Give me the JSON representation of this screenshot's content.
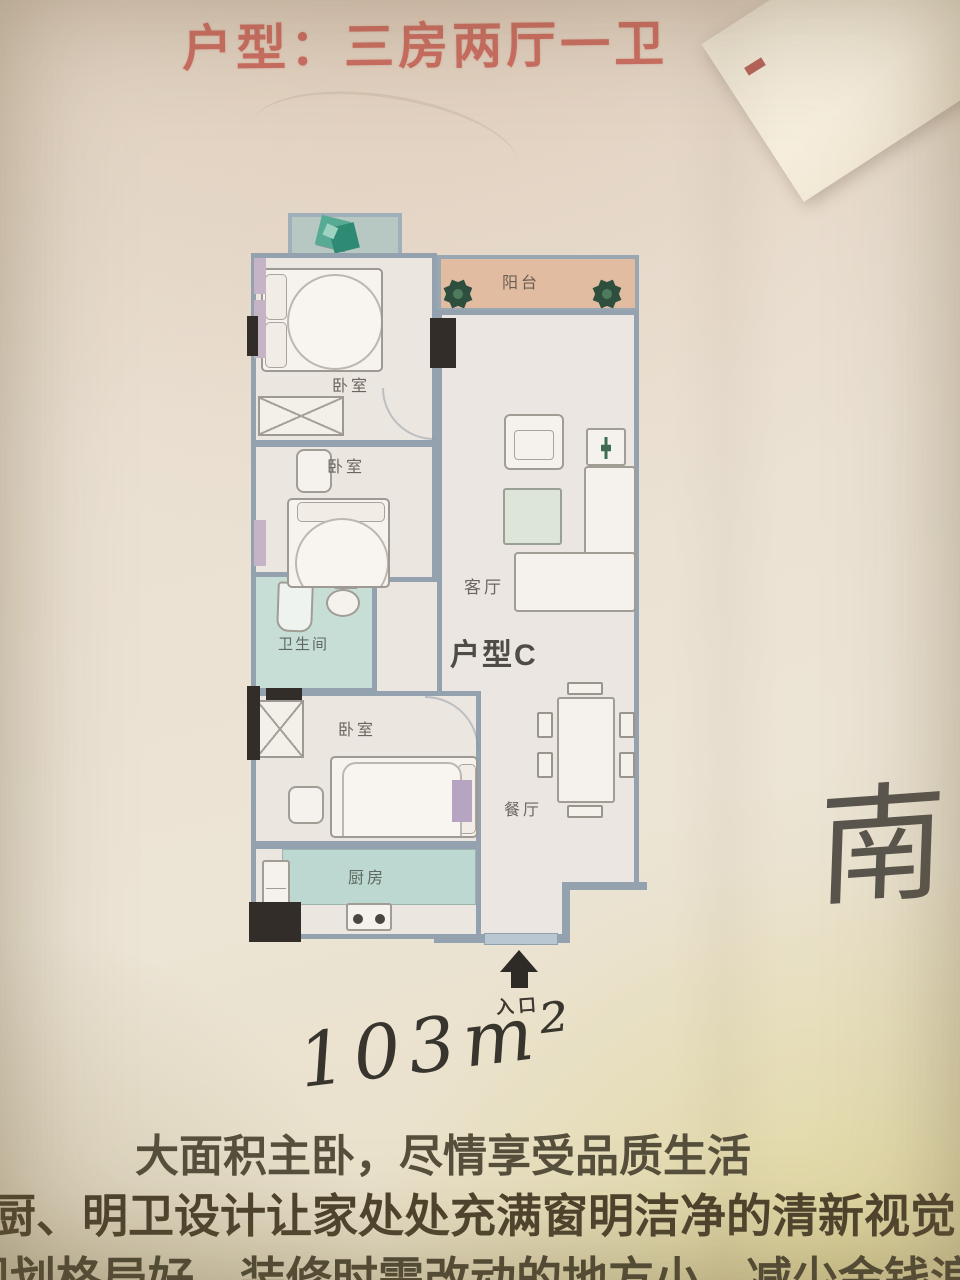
{
  "title": "户型：三房两厅一卫",
  "plan": {
    "unit_label": "户型C",
    "rooms": {
      "bedroom1": "卧室",
      "bedroom2": "卧室",
      "bedroom3": "卧室",
      "bathroom": "卫生间",
      "living": "客厅",
      "dining": "餐厅",
      "kitchen": "厨房",
      "balcony": "阳台"
    },
    "entrance_label": "入口"
  },
  "annotations": {
    "area_handwritten": "103m²",
    "direction_south": "南"
  },
  "footer": {
    "line1": "大面积主卧，尽情享受品质生活",
    "line2": "厨、明卫设计让家处处充满窗明洁净的清新视觉",
    "line3": "规划格局好，装修时需改动的地方小，减少金钱浪"
  },
  "colors": {
    "title_red": "#cb6e61",
    "wall": "#93a2ae",
    "balcony_salmon": "#e2bca1",
    "wet_teal": "#c7ded7",
    "room_pink": "#ece6e1",
    "text_olive": "#564f3c",
    "ink": "#38352f"
  }
}
